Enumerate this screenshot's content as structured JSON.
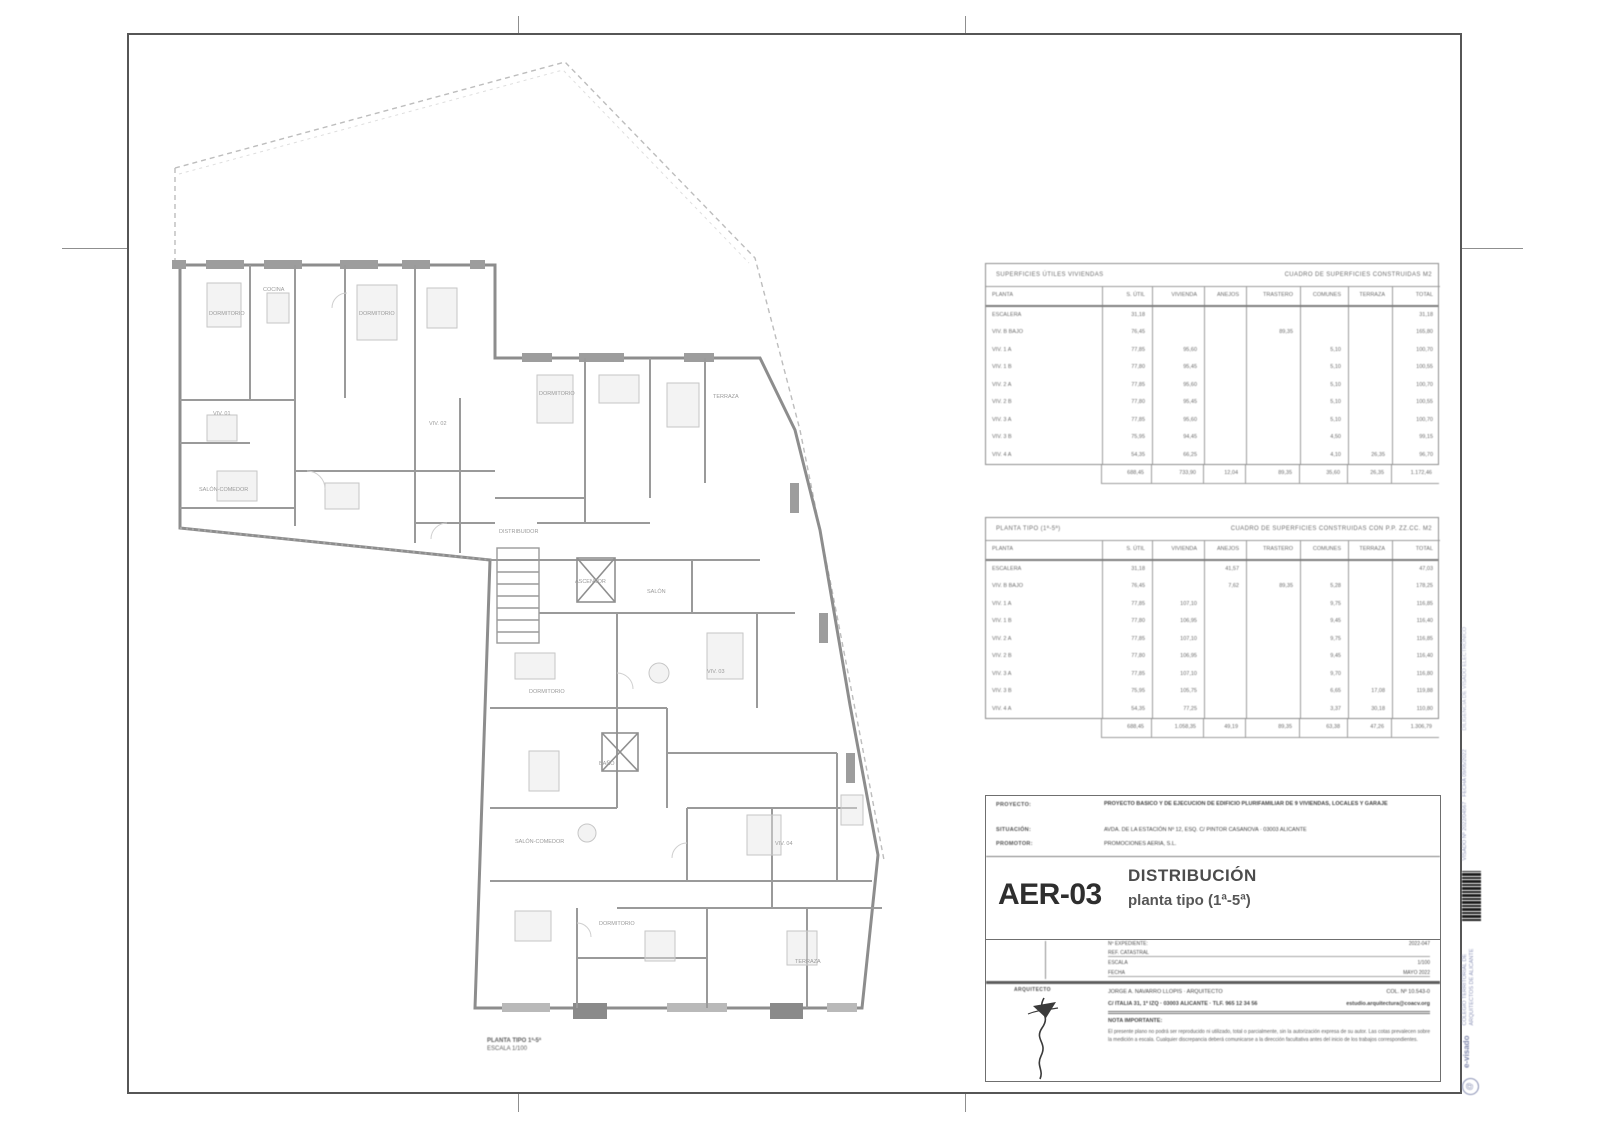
{
  "sheet": {
    "code": "AER-03",
    "title_line1": "DISTRIBUCIÓN",
    "title_line2": "planta tipo (1ª-5ª)"
  },
  "plan": {
    "caption_line1": "PLANTA TIPO 1ª-5ª",
    "caption_line2": "ESCALA 1/100",
    "labels": [
      {
        "t": "DORMITORIO",
        "x": 62,
        "y": 262
      },
      {
        "t": "COCINA",
        "x": 116,
        "y": 238
      },
      {
        "t": "DORMITORIO",
        "x": 212,
        "y": 262
      },
      {
        "t": "VIV. 01",
        "x": 66,
        "y": 362
      },
      {
        "t": "SALÓN-COMEDOR",
        "x": 52,
        "y": 438
      },
      {
        "t": "VIV. 02",
        "x": 282,
        "y": 372
      },
      {
        "t": "DORMITORIO",
        "x": 392,
        "y": 342
      },
      {
        "t": "TERRAZA",
        "x": 566,
        "y": 345
      },
      {
        "t": "DISTRIBUIDOR",
        "x": 352,
        "y": 480
      },
      {
        "t": "ASCENSOR",
        "x": 428,
        "y": 530
      },
      {
        "t": "SALÓN",
        "x": 500,
        "y": 540
      },
      {
        "t": "VIV. 03",
        "x": 560,
        "y": 620
      },
      {
        "t": "DORMITORIO",
        "x": 382,
        "y": 640
      },
      {
        "t": "BAÑO",
        "x": 452,
        "y": 712
      },
      {
        "t": "SALÓN-COMEDOR",
        "x": 368,
        "y": 790
      },
      {
        "t": "VIV. 04",
        "x": 628,
        "y": 792
      },
      {
        "t": "DORMITORIO",
        "x": 452,
        "y": 872
      },
      {
        "t": "TERRAZA",
        "x": 648,
        "y": 910
      }
    ]
  },
  "tables": {
    "headers": [
      "PLANTA",
      "S. ÚTIL",
      "VIVIENDA",
      "ANEJOS",
      "TRASTERO",
      "COMUNES",
      "TERRAZA",
      "TOTAL"
    ],
    "t1": {
      "title_left": "SUPERFICIES ÚTILES VIVIENDAS",
      "title_right": "CUADRO DE SUPERFICIES CONSTRUIDAS M2",
      "rows": [
        [
          "ESCALERA",
          "31,18",
          "",
          "",
          "",
          "",
          "",
          "31,18"
        ],
        [
          "VIV. B BAJO",
          "76,45",
          "",
          "",
          "89,35",
          "",
          "",
          "165,80"
        ],
        [
          "VIV. 1 A",
          "77,85",
          "95,60",
          "",
          "",
          "5,10",
          "",
          "100,70"
        ],
        [
          "VIV. 1 B",
          "77,80",
          "95,45",
          "",
          "",
          "5,10",
          "",
          "100,55"
        ],
        [
          "VIV. 2 A",
          "77,85",
          "95,60",
          "",
          "",
          "5,10",
          "",
          "100,70"
        ],
        [
          "VIV. 2 B",
          "77,80",
          "95,45",
          "",
          "",
          "5,10",
          "",
          "100,55"
        ],
        [
          "VIV. 3 A",
          "77,85",
          "95,60",
          "",
          "",
          "5,10",
          "",
          "100,70"
        ],
        [
          "VIV. 3 B",
          "75,95",
          "94,45",
          "",
          "",
          "4,50",
          "",
          "99,15"
        ],
        [
          "VIV. 4 A",
          "54,35",
          "66,25",
          "",
          "",
          "4,10",
          "26,35",
          "96,70"
        ]
      ],
      "totals": [
        "688,45",
        "733,90",
        "12,04",
        "89,35",
        "35,60",
        "26,35",
        "1.172,46"
      ]
    },
    "t2": {
      "title_left": "PLANTA TIPO (1ª-5ª)",
      "title_right": "CUADRO DE SUPERFICIES CONSTRUIDAS CON P.P. ZZ.CC. M2",
      "rows": [
        [
          "ESCALERA",
          "31,18",
          "",
          "41,57",
          "",
          "",
          "",
          "47,03"
        ],
        [
          "VIV. B BAJO",
          "76,45",
          "",
          "7,62",
          "89,35",
          "5,28",
          "",
          "178,25"
        ],
        [
          "VIV. 1 A",
          "77,85",
          "107,10",
          "",
          "",
          "9,75",
          "",
          "116,85"
        ],
        [
          "VIV. 1 B",
          "77,80",
          "106,95",
          "",
          "",
          "9,45",
          "",
          "116,40"
        ],
        [
          "VIV. 2 A",
          "77,85",
          "107,10",
          "",
          "",
          "9,75",
          "",
          "116,85"
        ],
        [
          "VIV. 2 B",
          "77,80",
          "106,95",
          "",
          "",
          "9,45",
          "",
          "116,40"
        ],
        [
          "VIV. 3 A",
          "77,85",
          "107,10",
          "",
          "",
          "9,70",
          "",
          "116,80"
        ],
        [
          "VIV. 3 B",
          "75,95",
          "105,75",
          "",
          "",
          "6,65",
          "17,08",
          "119,88"
        ],
        [
          "VIV. 4 A",
          "54,35",
          "77,25",
          "",
          "",
          "3,37",
          "30,18",
          "110,80"
        ]
      ],
      "totals": [
        "688,45",
        "1.058,35",
        "49,19",
        "89,35",
        "63,38",
        "47,26",
        "1.306,79"
      ]
    }
  },
  "titleblock": {
    "label_project": "PROYECTO:",
    "label_location": "SITUACIÓN:",
    "label_developer": "PROMOTOR:",
    "project_text": "PROYECTO BÁSICO Y DE EJECUCIÓN DE EDIFICIO PLURIFAMILIAR DE 9 VIVIENDAS, LOCALES Y GARAJE",
    "location_text": "AVDA. DE LA ESTACIÓN Nº 12, ESQ. C/ PINTOR CASANOVA · 03003 ALICANTE",
    "developer_text": "PROMOCIONES AERIA, S.L.",
    "field1_label": "Nº EXPEDIENTE:",
    "field1_value": "2022-047",
    "field2_label": "REF. CATASTRAL",
    "field2_value": "",
    "field3_label": "ESCALA",
    "field3_value": "1/100",
    "field4_label": "FECHA",
    "field4_value": "MAYO 2022",
    "sign_label": "ARQUITECTO",
    "architect_name": "JORGE A. NAVARRO LLOPIS · ARQUITECTO",
    "architect_number": "COL. Nº 10.543-0",
    "architect_address": "C/ ITALIA 31, 1º IZQ · 03003 ALICANTE · TLF. 965 12 34 56",
    "architect_email": "estudio.arquitectura@coacv.org",
    "note_heading": "NOTA IMPORTANTE:",
    "note_text": "El presente plano no podrá ser reproducido ni utilizado, total o parcialmente, sin la autorización expresa de su autor. Las cotas prevalecen sobre la medición a escala. Cualquier discrepancia deberá comunicarse a la dirección facultativa antes del inicio de los trabajos correspondientes."
  },
  "stamp": {
    "top_text": "DILIGENCIA DE VISADO ELECTRÓNICO",
    "visa_text": "VISADO Nº 2022/04567 · FECHA 09/05/2022",
    "college_text": "COLEGIO TERRITORIAL DE ARQUITECTOS DE ALICANTE",
    "wordmark": "e-visado",
    "logo_glyph": "@"
  }
}
